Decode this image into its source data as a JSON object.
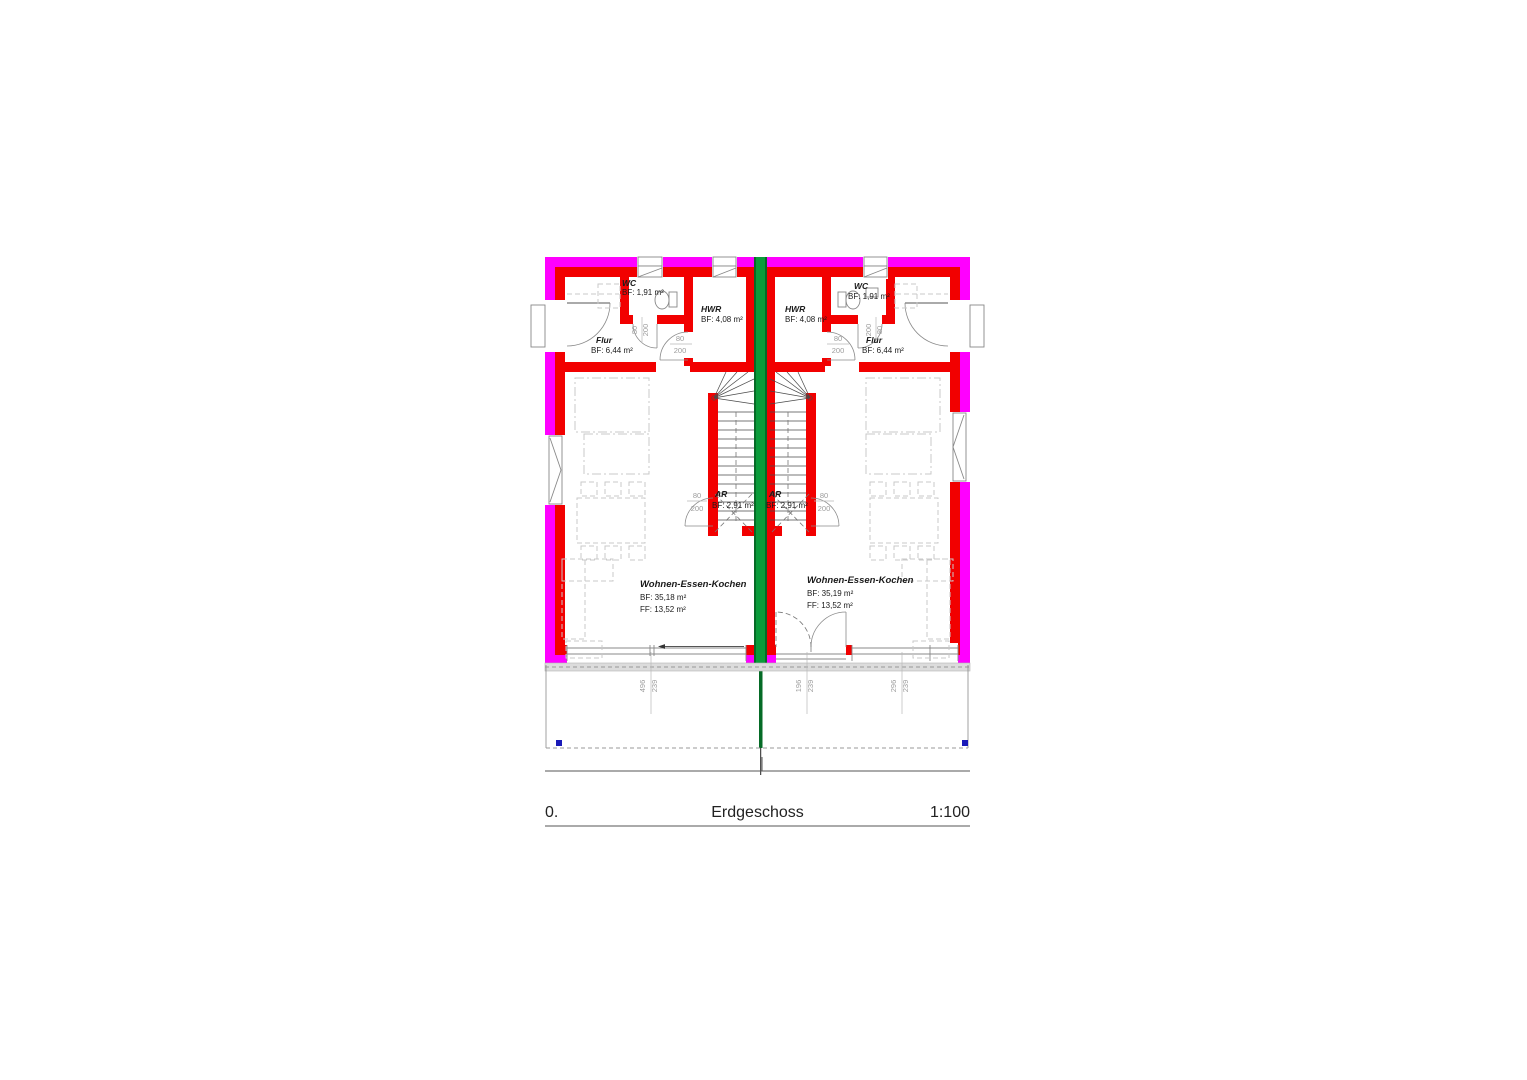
{
  "title": {
    "index": "0.",
    "name": "Erdgeschoss",
    "scale": "1:100"
  },
  "labels": {
    "l_wc_name": "WC",
    "l_wc_area": "BF: 1,91 m²",
    "l_hwr_name": "HWR",
    "l_hwr_area": "BF: 4,08 m²",
    "l_flur_name": "Flur",
    "l_flur_area": "BF: 6,44 m²",
    "l_ar_name": "AR",
    "l_ar_area": "BF: 2,91 m²",
    "l_wek_name": "Wohnen-Essen-Kochen",
    "l_wek_bf": "BF: 35,18 m²",
    "l_wek_ff": "FF: 13,52 m²",
    "r_wc_name": "WC",
    "r_wc_area": "BF: 1,91 m²",
    "r_hwr_name": "HWR",
    "r_hwr_area": "BF: 4,08 m²",
    "r_flur_name": "Flur",
    "r_flur_area": "BF: 6,44 m²",
    "r_ar_name": "AR",
    "r_ar_area": "BF: 2,91 m²",
    "r_wek_name": "Wohnen-Essen-Kochen",
    "r_wek_bf": "BF: 35,19 m²",
    "r_wek_ff": "FF: 13,52 m²"
  },
  "door_dims": {
    "w": "80",
    "h": "200"
  },
  "openings": {
    "w1": "496",
    "h1": "239",
    "w2": "196",
    "h2": "239",
    "w3": "296",
    "h3": "239"
  },
  "colors": {
    "outer_wall": "#ff00ff",
    "inner_wall": "#f20000",
    "party_wall": "#0a9c3a",
    "party_wall_edge": "#056b26",
    "terrace_marker": "#1a1ab8"
  }
}
